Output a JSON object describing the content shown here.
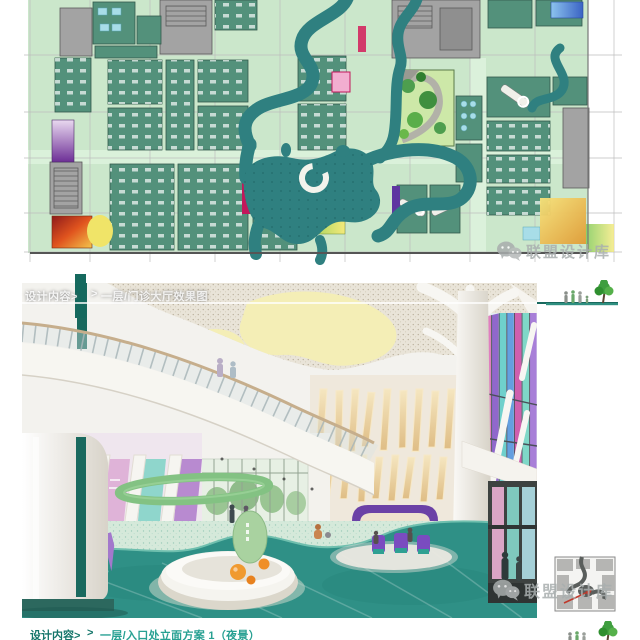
{
  "header": {
    "label": "设计内容>",
    "chevron": ">",
    "title": "一层/门诊大厅效果图"
  },
  "caption": {
    "label": "设计内容>",
    "chevron": ">",
    "title": "一层/入口处立面方案 1（夜景）"
  },
  "watermark": {
    "text": "联盟设计库",
    "icon": "wechat-icon"
  },
  "sidebar": {
    "corner_icon": "tree-people-icon",
    "key_plan_icon": "key-plan-thumbnail"
  },
  "palette": {
    "accent_teal": "#15695e",
    "caption_teal": "#27a092",
    "plan_field_green": "#cbe7cb",
    "plan_room_green": "#53917b",
    "plan_river_teal": "#2f8080",
    "render_floor_teal": "#2f9086",
    "ceiling_yellow": "#f4eeb6",
    "purple_accent": "#6b41a6",
    "watermark_gray": "#a9afaf"
  }
}
